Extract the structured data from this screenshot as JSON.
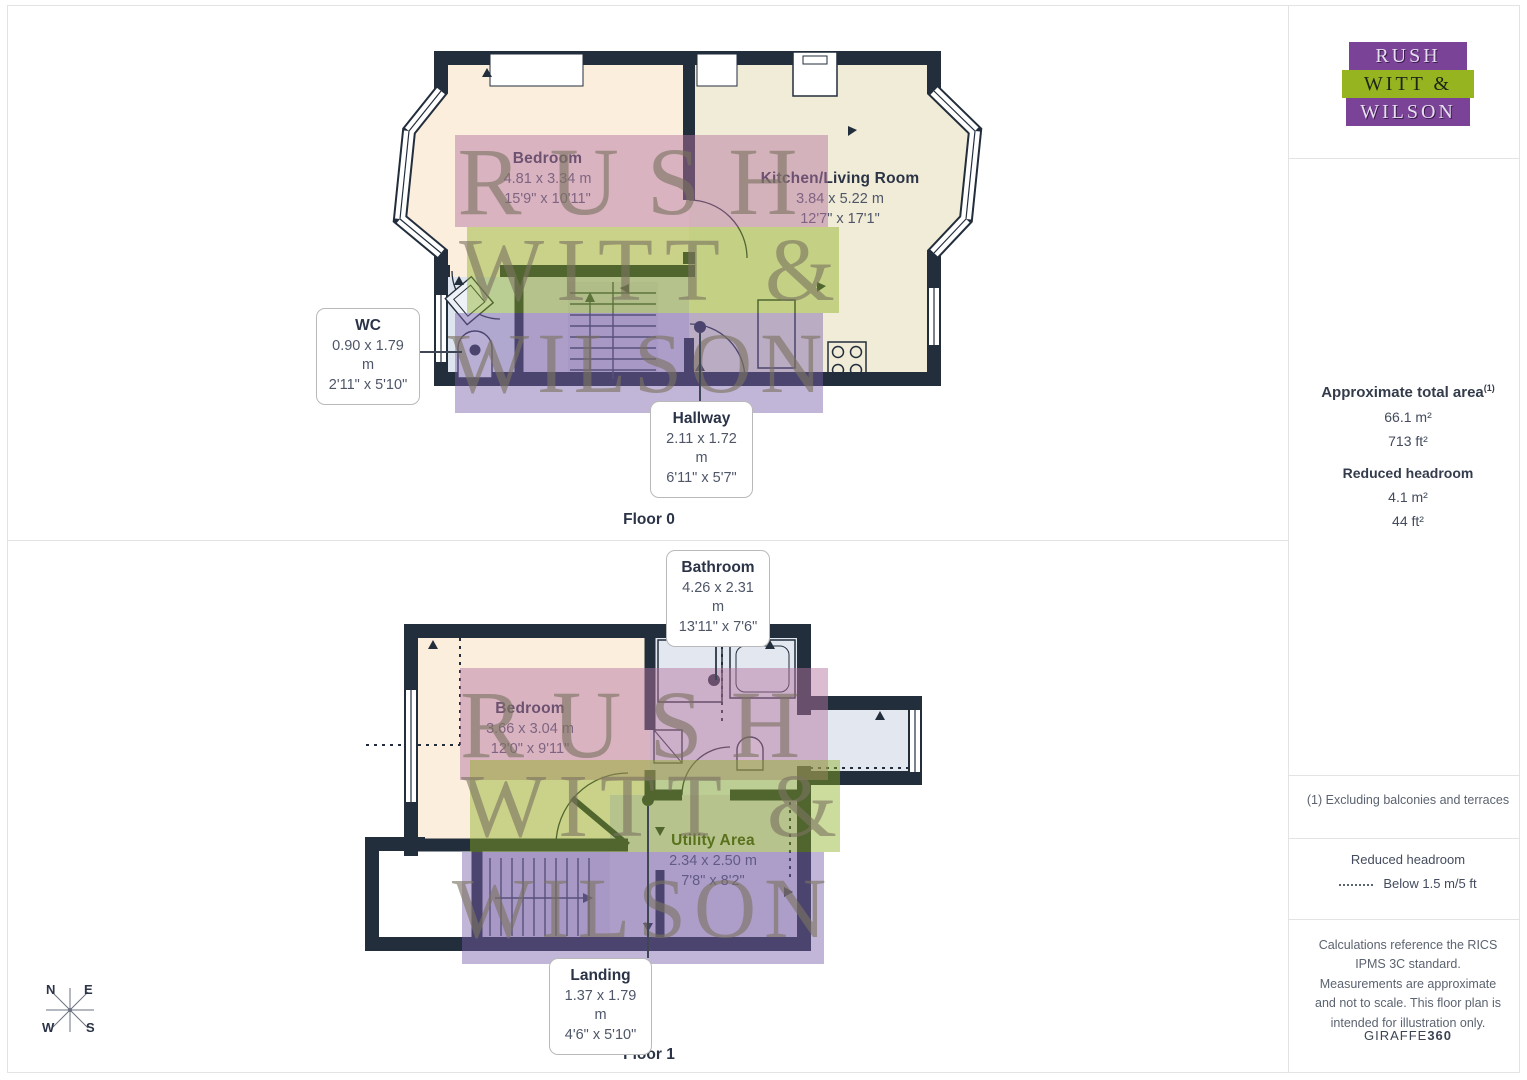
{
  "watermark": {
    "line1": "RUSH",
    "line2": "WITT &",
    "line3": "WILSON"
  },
  "compass": {
    "n": "N",
    "e": "E",
    "s": "S",
    "w": "W"
  },
  "floor0": {
    "caption": "Floor 0",
    "rooms": [
      {
        "name": "Bedroom",
        "metric": "4.81 x 3.34 m",
        "imperial": "15'9\" x 10'11\""
      },
      {
        "name": "Kitchen/Living Room",
        "metric": "3.84 x 5.22 m",
        "imperial": "12'7\" x 17'1\""
      },
      {
        "name": "WC",
        "metric": "0.90 x 1.79 m",
        "imperial": "2'11\" x 5'10\""
      },
      {
        "name": "Hallway",
        "metric": "2.11 x 1.72 m",
        "imperial": "6'11\" x 5'7\""
      }
    ]
  },
  "floor1": {
    "caption": "Floor 1",
    "rooms": [
      {
        "name": "Bathroom",
        "metric": "4.26 x 2.31 m",
        "imperial": "13'11\" x 7'6\""
      },
      {
        "name": "Bedroom",
        "metric": "3.66 x 3.04 m",
        "imperial": "12'0\" x 9'11\""
      },
      {
        "name": "Utility Area",
        "metric": "2.34 x 2.50 m",
        "imperial": "7'8\" x 8'2\""
      },
      {
        "name": "Landing",
        "metric": "1.37 x 1.79 m",
        "imperial": "4'6\" x 5'10\""
      }
    ]
  },
  "sidebar": {
    "logo": {
      "line1": "RUSH",
      "line2": "WITT &",
      "line3": "WILSON"
    },
    "area": {
      "title": "Approximate total area",
      "superscript": "(1)",
      "m2": "66.1 m²",
      "ft2": "713 ft²"
    },
    "reduced": {
      "title": "Reduced headroom",
      "m2": "4.1 m²",
      "ft2": "44 ft²"
    },
    "note1": "(1) Excluding balconies and terraces",
    "legend": {
      "title": "Reduced headroom",
      "label": "Below 1.5 m/5 ft"
    },
    "disclaimer": "Calculations reference the RICS IPMS 3C standard. Measurements are approximate and not to scale. This floor plan is intended for illustration only.",
    "brand": {
      "name": "GIRAFFE",
      "suffix": "360"
    }
  },
  "colors": {
    "wall": "#232e3c",
    "bedroom_fill": "#fbeedd",
    "kitchen_fill": "#f1ecd7",
    "wet_fill": "#e2e7f0",
    "hall_fill": "#d7d1e3",
    "logo_purple": "#7b4397",
    "logo_green": "#96b41f",
    "band_pink": "rgba(180,115,158,0.48)",
    "band_green": "rgba(140,176,30,0.44)",
    "band_purple": "rgba(122,95,170,0.46)"
  }
}
